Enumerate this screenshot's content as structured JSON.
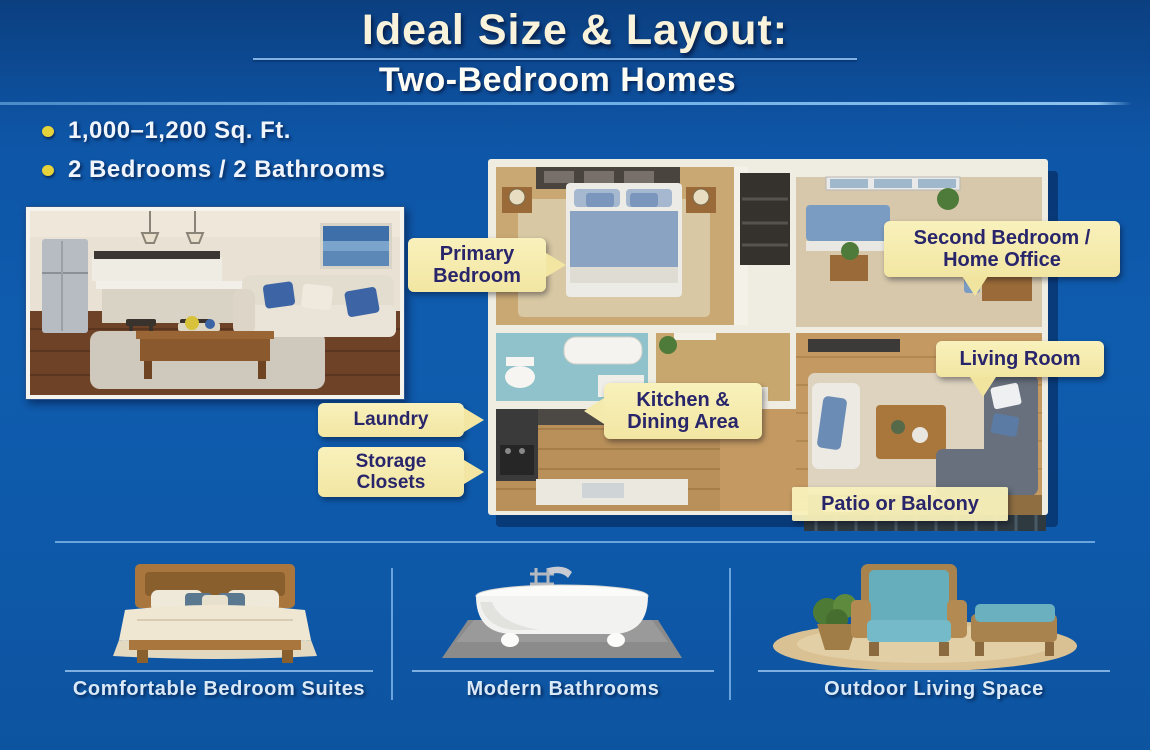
{
  "slide": {
    "title": "Ideal Size & Layout:",
    "subtitle": "Two-Bedroom Homes"
  },
  "specs": [
    {
      "text": "1,000–1,200 Sq. Ft."
    },
    {
      "text": "2 Bedrooms / 2 Bathrooms"
    }
  ],
  "floor_plan": {
    "callouts": [
      {
        "id": "primary-bedroom",
        "text": "Primary Bedroom"
      },
      {
        "id": "second-bedroom-home-office",
        "text": "Second Bedroom / Home Office"
      },
      {
        "id": "living-room",
        "text": "Living Room"
      },
      {
        "id": "kitchen-dining-area",
        "text": "Kitchen & Dining Area"
      },
      {
        "id": "laundry",
        "text": "Laundry"
      },
      {
        "id": "storage-closets",
        "text": "Storage Closets"
      },
      {
        "id": "patio-or-balcony",
        "text": "Patio or Balcony"
      }
    ]
  },
  "features": [
    {
      "caption": "Comfortable Bedroom Suites",
      "icon": "bed-illustration"
    },
    {
      "caption": "Modern Bathrooms",
      "icon": "bathtub-illustration"
    },
    {
      "caption": "Outdoor Living Space",
      "icon": "outdoor-furniture-illustration"
    }
  ],
  "colors": {
    "background_top": "#0b3f80",
    "background_main": "#0f5cae",
    "title_text": "#f8f3da",
    "subtitle_text": "#fdfdf6",
    "bullet_dot": "#e6d33c",
    "callout_bg": "#f6ecac",
    "callout_text": "#29256b",
    "divider_line": "#69a5dc",
    "caption_text": "#d9e9f8"
  }
}
